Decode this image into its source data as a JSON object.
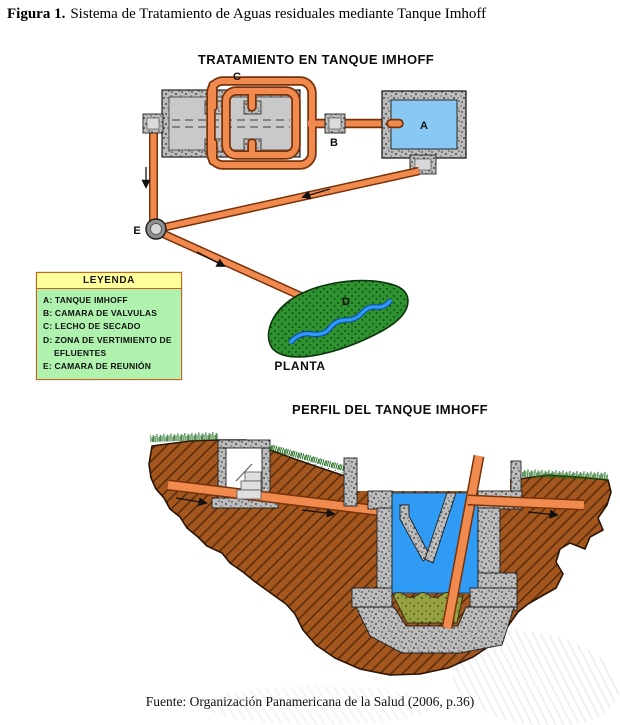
{
  "figure": {
    "label": "Figura 1.",
    "caption": "Sistema de Tratamiento de Aguas residuales mediante Tanque Imhoff"
  },
  "plan": {
    "title": "TRATAMIENTO EN TANQUE IMHOFF",
    "caption": "PLANTA",
    "labels": {
      "tank": "A",
      "valves": "B",
      "dryingBed": "C",
      "discharge": "D",
      "junction": "E"
    }
  },
  "legend": {
    "title": "LEYENDA",
    "items": [
      "A: TANQUE IMHOFF",
      "B: CAMARA DE VALVULAS",
      "C: LECHO DE SECADO",
      "D: ZONA DE VERTIMIENTO DE EFLUENTES",
      "E: CAMARA DE REUNIÓN"
    ]
  },
  "profile": {
    "title": "PERFIL DEL TANQUE IMHOFF"
  },
  "source": {
    "text": "Fuente: Organización Panamericana de la Salud (2006, p.36)"
  },
  "colors": {
    "pipe": "#F08A4E",
    "pipe_edge": "#79320A",
    "plan_water": "#87C9F3",
    "profile_water": "#2F9BF5",
    "earth": "#A3571E",
    "concrete": "#BDBDBD",
    "vegetation_area": "#2E9230",
    "grass": "#1B6B1B",
    "sludge": "#96A23F",
    "legend_header_bg": "#FFFF9C",
    "legend_body_bg": "#AEF2AE",
    "river": "#2E9AFF"
  }
}
